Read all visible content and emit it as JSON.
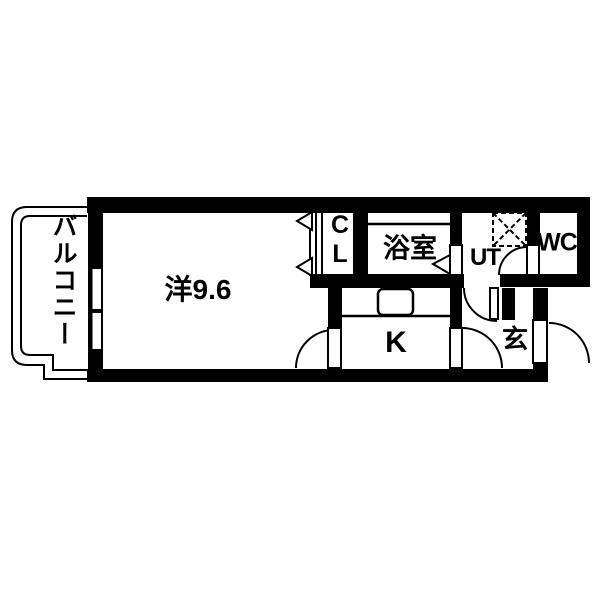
{
  "plan": {
    "kind": "apartment-floor-plan",
    "wall_color": "#000000",
    "floor_color": "#ffffff",
    "rooms": {
      "balcony": {
        "label": "バルコニー"
      },
      "main_room": {
        "label": "洋9.6"
      },
      "closet": {
        "label_top": "C",
        "label_bottom": "L"
      },
      "bathroom": {
        "label": "浴室"
      },
      "utility": {
        "label": "UT"
      },
      "toilet": {
        "label": "WC"
      },
      "kitchen": {
        "label": "K"
      },
      "entrance": {
        "label": "玄"
      }
    },
    "fixtures": {
      "washing_machine_pan": "dashed-square-x",
      "kitchen_sink": "rounded-rect",
      "bathtub_edge": "line",
      "window": "double-sash",
      "doors": [
        "hinged-arc",
        "bifold-triangles",
        "folding-triangle"
      ]
    }
  }
}
